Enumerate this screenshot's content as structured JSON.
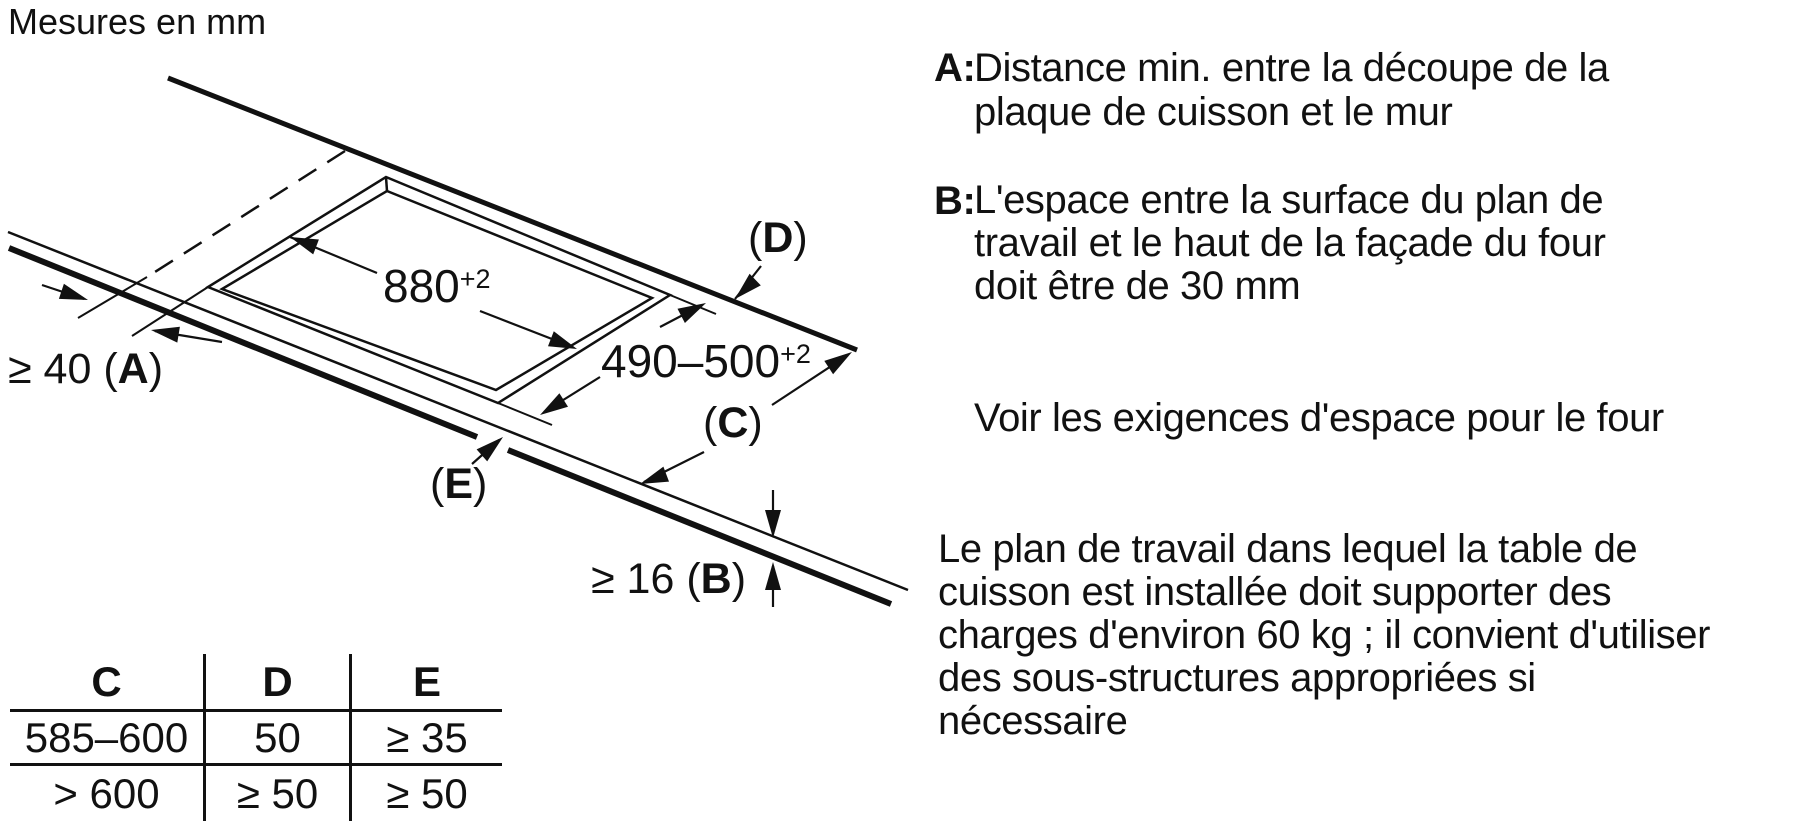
{
  "title": "Mesures en mm",
  "diagram": {
    "dim_880": {
      "value": "880",
      "tol": "+2"
    },
    "dim_490": {
      "value": "490–500",
      "tol": "+2"
    },
    "dim_a": {
      "prefix": "≥ 40 (",
      "letter": "A",
      "suffix": ")"
    },
    "dim_b": {
      "prefix": "≥ 16 (",
      "letter": "B",
      "suffix": ")"
    },
    "label_c": {
      "prefix": "(",
      "letter": "C",
      "suffix": ")"
    },
    "label_d": {
      "prefix": "(",
      "letter": "D",
      "suffix": ")"
    },
    "label_e": {
      "prefix": "(",
      "letter": "E",
      "suffix": ")"
    }
  },
  "table": {
    "headers": [
      "C",
      "D",
      "E"
    ],
    "rows": [
      [
        "585–600",
        "50",
        "≥ 35"
      ],
      [
        "> 600",
        "≥ 50",
        "≥ 50"
      ]
    ]
  },
  "legend": {
    "a": {
      "label": "A:",
      "lines": [
        "Distance min. entre la découpe de la",
        "plaque de cuisson et le mur"
      ]
    },
    "b": {
      "label": "B:",
      "lines": [
        "L'espace entre la surface du plan de",
        "travail et le haut de la façade du four",
        "doit être de 30 mm"
      ]
    },
    "note_four": "Voir les exigences d'espace pour le four",
    "paragraph": [
      "Le plan de travail dans lequel la table de",
      "cuisson est installée doit supporter des",
      "charges d'environ 60 kg ; il convient d'utiliser",
      "des sous-structures appropriées si",
      "nécessaire"
    ]
  },
  "colors": {
    "ink": "#111111",
    "background": "#ffffff"
  }
}
